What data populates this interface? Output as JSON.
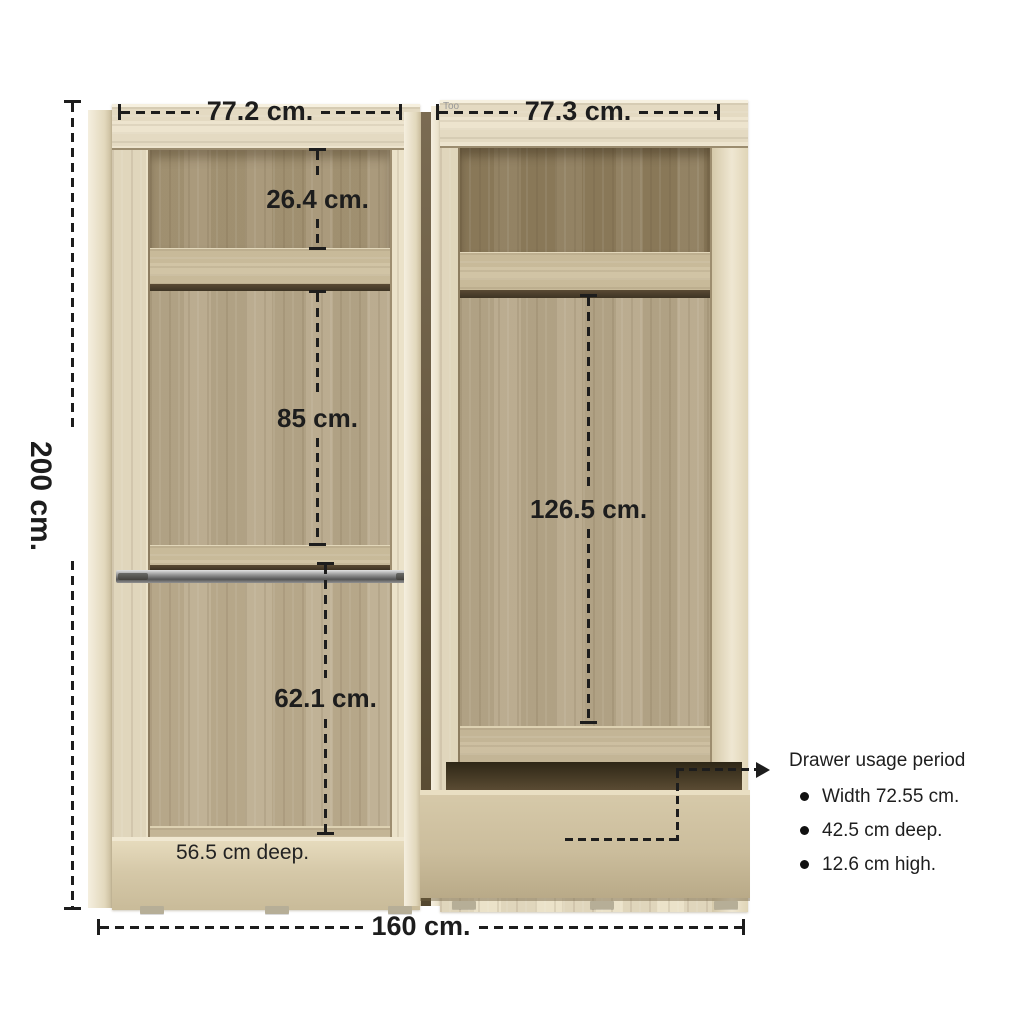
{
  "title": "Wardrobe dimensions diagram",
  "watermark": "Too",
  "overall": {
    "height_label": "200 cm.",
    "width_label": "160 cm."
  },
  "units": {
    "left": {
      "width_label": "77.2 cm.",
      "top_section_label": "26.4 cm.",
      "middle_section_label": "85 cm.",
      "bottom_section_label": "62.1 cm.",
      "depth_label": "56.5 cm deep."
    },
    "right": {
      "width_label": "77.3 cm.",
      "hanging_section_label": "126.5 cm."
    }
  },
  "drawer_callout": {
    "title": "Drawer usage period",
    "bullets": [
      "Width 72.55 cm.",
      "42.5 cm deep.",
      "12.6 cm high."
    ]
  },
  "colors": {
    "background": "#ffffff",
    "frame_wood": "#eae0c6",
    "interior_wood": "#b5a689",
    "interior_wood_dark": "#8d7c5c",
    "shelf_wood": "#cfc1a0",
    "shadow_wood": "#4a3c2a",
    "drawer_wood": "#cbbd9c",
    "rail_metal": "#7d7d7d",
    "dimension_text": "#1d1d1d",
    "watermark_gray": "#999999"
  }
}
